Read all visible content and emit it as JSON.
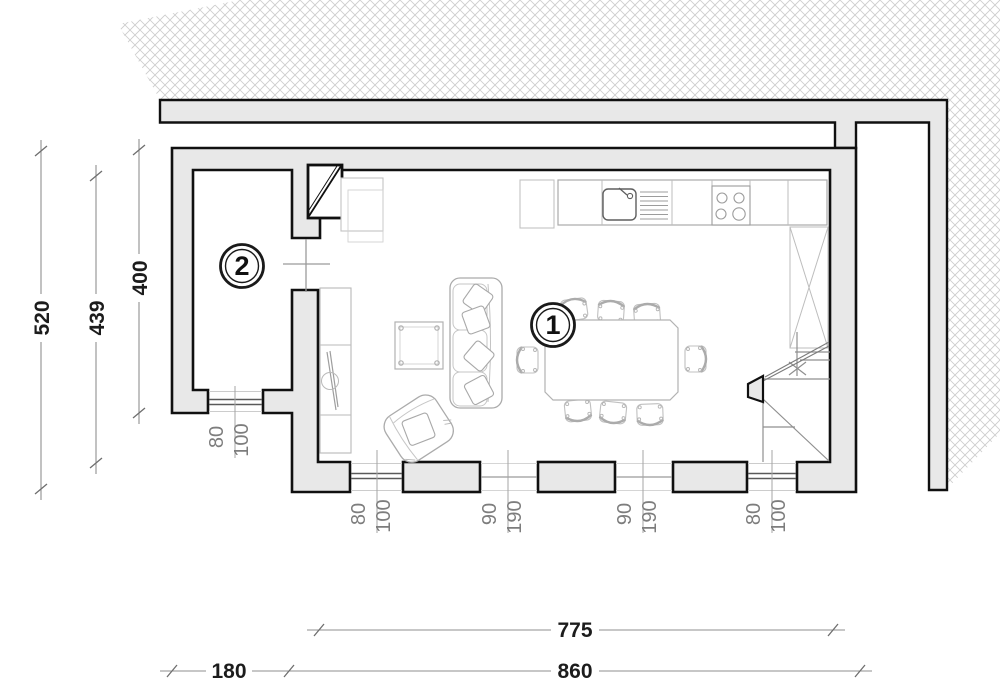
{
  "floorplan": {
    "type": "architectural-floor-plan",
    "rooms": [
      {
        "number": "1",
        "name": "living-dining-kitchen"
      },
      {
        "number": "2",
        "name": "side-room"
      }
    ],
    "overall_dimensions": [
      {
        "id": "left-overall-height",
        "value": "520"
      },
      {
        "id": "left-inner-height",
        "value": "439"
      },
      {
        "id": "left-room2-height",
        "value": "400"
      },
      {
        "id": "bottom-living-width",
        "value": "775"
      },
      {
        "id": "bottom-left-section",
        "value": "180"
      },
      {
        "id": "bottom-main-section",
        "value": "860"
      }
    ],
    "opening_dimensions": [
      {
        "id": "room2-window",
        "width": "80",
        "height": "100"
      },
      {
        "id": "south-window-left",
        "width": "80",
        "height": "100"
      },
      {
        "id": "south-door-left",
        "width": "90",
        "height": "190"
      },
      {
        "id": "south-door-right",
        "width": "90",
        "height": "190"
      },
      {
        "id": "south-window-right",
        "width": "80",
        "height": "100"
      }
    ],
    "fixtures": [
      "kitchen-counter-with-sink-and-hob",
      "tall-cabinet-x-front",
      "chimney-flue",
      "sofa-three-seat",
      "coffee-table",
      "armchair",
      "tv-unit",
      "dining-table-eight-chairs",
      "staircase"
    ],
    "colors": {
      "wall_fill": "#e8e8e8",
      "wall_outline": "#101010",
      "hatch_line": "#cbcbcb",
      "dimension_line": "#8f8f8f",
      "dimension_text": "#1c1c1c",
      "opening_text": "#7d7d7d",
      "furniture_line": "#b2b2b2"
    }
  }
}
